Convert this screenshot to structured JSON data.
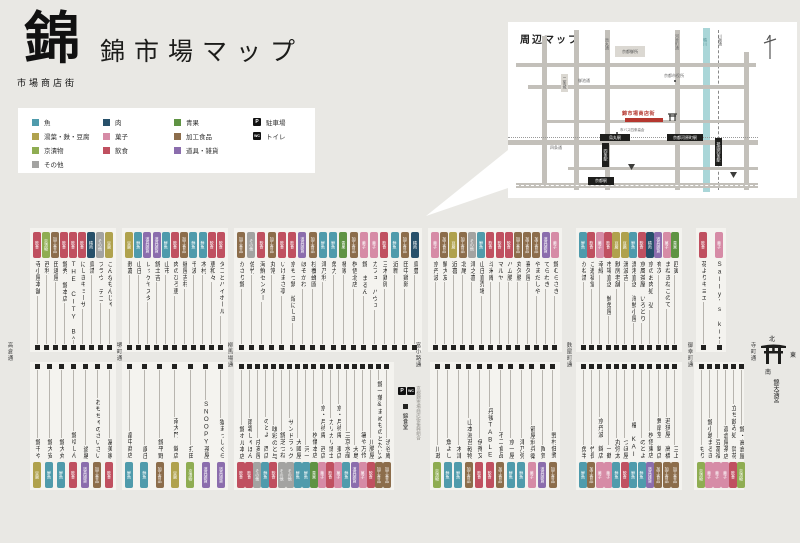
{
  "header": {
    "logo": "錦",
    "logo_sub": "市場商店街",
    "title": "錦市場マップ"
  },
  "categories": {
    "fish": {
      "label": "魚",
      "chip": "鮮魚",
      "color": "#4f9bac"
    },
    "tofu": {
      "label": "湯葉・麩・豆腐",
      "chip": "豆腐",
      "color": "#b0a24d"
    },
    "pickles": {
      "label": "京漬物",
      "chip": "京漬物",
      "color": "#8fad52"
    },
    "other": {
      "label": "その他",
      "chip": "その他",
      "color": "#a3a3a1"
    },
    "meat": {
      "label": "肉",
      "chip": "精肉",
      "color": "#27506a"
    },
    "sweets": {
      "label": "菓子",
      "chip": "菓子",
      "color": "#d68ba6"
    },
    "dining": {
      "label": "飲食",
      "chip": "飲食",
      "color": "#c05060"
    },
    "produce": {
      "label": "青果",
      "chip": "青果",
      "color": "#5f9343"
    },
    "processed": {
      "label": "加工食品",
      "chip": "加工食品",
      "color": "#8c6d4b"
    },
    "goods": {
      "label": "道具・雑貨",
      "chip": "道具雑貨",
      "color": "#8b6dad"
    }
  },
  "legend_order": [
    [
      "fish",
      "tofu",
      "pickles",
      "other"
    ],
    [
      "meat",
      "sweets",
      "dining"
    ],
    [
      "produce",
      "processed",
      "goods"
    ]
  ],
  "facilities": [
    {
      "icon": "P",
      "label": "駐車場"
    },
    {
      "icon": "WC",
      "label": "トイレ"
    }
  ],
  "minimap": {
    "title": "周辺マップ",
    "highlight": "錦市場商店街",
    "stations": {
      "karasuma": "烏丸駅",
      "shijo_sta": "四条駅",
      "kawaramachi_sta": "京都河原町駅",
      "gion": "祇園四条駅",
      "kyoto": "京都駅"
    },
    "landmarks": {
      "gosho": "京都御所",
      "cityhall": "京都市役所",
      "nijo": "二条城",
      "bus": "市バス四条高倉"
    },
    "streets": {
      "karasuma": "烏丸通",
      "kawaramachi": "河原町通",
      "kawabata": "川端通",
      "kamo": "鴨川",
      "oike": "御池通",
      "shijo": "四条通"
    }
  },
  "streets": [
    "高倉通",
    "堺町通",
    "柳馬場通",
    "富小路通",
    "麩屋町通",
    "御幸町通",
    "寺町通"
  ],
  "compass": {
    "n": "北",
    "e": "東",
    "s": "南",
    "shrine": "錦天満宮"
  },
  "parking_block": {
    "p": "P",
    "toilet": "WC",
    "shop": "錦食堂",
    "office": "京都錦市場商店街振興組合"
  },
  "top_blocks": [
    {
      "shops": [
        {
          "n": "寺小屋本舗",
          "c": "dining"
        },
        {
          "n": "西利",
          "c": "pickles"
        },
        {
          "n": "田邊屋",
          "c": "processed"
        },
        {
          "n": "錦秀 錦本店",
          "c": "dining"
        },
        {
          "n": "THE CITY BAKERY",
          "c": "dining"
        },
        {
          "n": "にしきギョーザ",
          "c": "dining"
        },
        {
          "n": "鳥清",
          "c": "meat"
        },
        {
          "n": "ブラウ デコ",
          "c": "other"
        },
        {
          "n": "こんなもんじゃ",
          "c": "tofu"
        }
      ]
    },
    {
      "shops": [
        {
          "n": "麩嘉",
          "c": "tofu"
        },
        {
          "n": "山庄",
          "c": "fish"
        },
        {
          "n": "レッゲヤスダ",
          "c": "goods"
        },
        {
          "n": "錦土吉",
          "c": "goods"
        },
        {
          "n": "山市",
          "c": "fish"
        },
        {
          "n": "肉のひろ恵",
          "c": "dining"
        },
        {
          "n": "縁屋吉村",
          "c": "processed"
        },
        {
          "n": "千波",
          "c": "fish"
        },
        {
          "n": "木村",
          "c": "fish"
        },
        {
          "n": "恵和々",
          "c": "dining"
        },
        {
          "n": "タコとハイボール",
          "c": "dining"
        }
      ]
    },
    {
      "shops": [
        {
          "n": "かざり錦",
          "c": "processed"
        },
        {
          "n": "佐竹",
          "c": "other"
        },
        {
          "n": "海鮮センター",
          "c": "dining"
        },
        {
          "n": "丸常",
          "c": "processed"
        },
        {
          "n": "いけまさ亭",
          "c": "dining"
        },
        {
          "n": "京もつ鍋 焔にしき",
          "c": "dining"
        },
        {
          "n": "ほそかわ",
          "c": "goods"
        },
        {
          "n": "杉養蜂園",
          "c": "processed"
        },
        {
          "n": "津乃利",
          "c": "fish"
        },
        {
          "n": "魚力",
          "c": "fish"
        },
        {
          "n": "椿家",
          "c": "produce"
        },
        {
          "n": "桝俉北店",
          "c": "processed"
        },
        {
          "n": "錦 まるん",
          "c": "sweets"
        },
        {
          "n": "カフェ パヴェ",
          "c": "sweets"
        },
        {
          "n": "三木鶏卵",
          "c": "dining"
        },
        {
          "n": "近新",
          "c": "fish"
        },
        {
          "n": "田中鶏卵",
          "c": "processed"
        },
        {
          "n": "鳥豊",
          "c": "meat"
        }
      ]
    },
    {
      "shops": [
        {
          "n": "京丹波",
          "c": "sweets"
        },
        {
          "n": "鯛大友",
          "c": "processed"
        },
        {
          "n": "近喜",
          "c": "tofu"
        },
        {
          "n": "北尾",
          "c": "processed"
        },
        {
          "n": "津之喜",
          "c": "other"
        },
        {
          "n": "山庄直売場",
          "c": "fish"
        },
        {
          "n": "斗米庵",
          "c": "dining"
        },
        {
          "n": "マルヤ",
          "c": "dining"
        },
        {
          "n": "ハム勝",
          "c": "dining"
        },
        {
          "n": "丸久勝",
          "c": "processed"
        },
        {
          "n": "喜久屋",
          "c": "processed"
        },
        {
          "n": "やまだしや",
          "c": "processed"
        },
        {
          "n": "てらわき",
          "c": "goods"
        },
        {
          "n": "錦むらさき",
          "c": "sweets"
        }
      ]
    },
    {
      "shops": [
        {
          "n": "かね清",
          "c": "fish"
        },
        {
          "n": "ご進福堂",
          "c": "dining"
        },
        {
          "n": "幸緑",
          "c": "sweets"
        },
        {
          "n": "市場直送 鮮魚屋",
          "c": "dining"
        },
        {
          "n": "麩房老舗",
          "c": "tofu"
        },
        {
          "n": "湯波吉",
          "c": "tofu"
        },
        {
          "n": "漁港直送 海鮮小屋",
          "c": "fish"
        },
        {
          "n": "京風茶屋 いろどり",
          "c": "dining"
        },
        {
          "n": "京のお肉処 弘",
          "c": "meat"
        },
        {
          "n": "有次",
          "c": "goods"
        },
        {
          "n": "まねきねこのて",
          "c": "sweets"
        },
        {
          "n": "四寅",
          "c": "produce"
        }
      ]
    },
    {
      "shops": [
        {
          "n": "花よりキヨエ",
          "c": "dining"
        },
        {
          "n": "Sally's kitchen",
          "c": "sweets"
        }
      ]
    }
  ],
  "bottom_blocks": [
    {
      "shops": [
        {
          "n": "錦千や",
          "c": "tofu"
        },
        {
          "n": "錦大安",
          "c": "fish"
        },
        {
          "n": "錦大丸",
          "c": "fish"
        },
        {
          "n": "錦ゆしん",
          "c": "dining"
        },
        {
          "n": "遊膳",
          "c": "goods"
        },
        {
          "n": "おもちゃのさいさい",
          "c": "processed"
        },
        {
          "n": "冨美家",
          "c": "dining"
        }
      ]
    },
    {
      "shops": [
        {
          "n": "畠中商店",
          "c": "fish"
        },
        {
          "n": "廣庄",
          "c": "fish"
        },
        {
          "n": "錦平野",
          "c": "processed"
        },
        {
          "n": "南大門 錦店",
          "c": "tofu"
        },
        {
          "n": "打田",
          "c": "pickles"
        },
        {
          "n": "SNOOPY茶屋",
          "c": "goods"
        },
        {
          "n": "猫まっしぐら",
          "c": "goods"
        }
      ]
    },
    {
      "shops": [
        {
          "n": "錦ホル本店",
          "c": "dining"
        },
        {
          "n": "雨霜しゃぼん",
          "c": "dining"
        },
        {
          "n": "戌亥屋",
          "c": "other"
        },
        {
          "n": "のとよ 西店",
          "c": "fish"
        },
        {
          "n": "味彩のと与",
          "c": "dining"
        },
        {
          "n": "錦芝つね",
          "c": "other"
        },
        {
          "n": "サンドラッグ",
          "c": "other"
        },
        {
          "n": "大國屋",
          "c": "fish"
        },
        {
          "n": "河一",
          "c": "fish"
        },
        {
          "n": "桝儀本店",
          "c": "produce"
        },
        {
          "n": "京・月待庵 西店",
          "c": "sweets"
        },
        {
          "n": "カリカリ博士",
          "c": "dining"
        },
        {
          "n": "京・月待庵 東店",
          "c": "sweets"
        },
        {
          "n": "三京水産",
          "c": "fish"
        },
        {
          "n": "大島",
          "c": "goods"
        },
        {
          "n": "箸や万作",
          "c": "sweets"
        },
        {
          "n": "川勝屋",
          "c": "dining"
        },
        {
          "n": "錦一葉&まめものとたいやき",
          "c": "processed"
        },
        {
          "n": "渋谷庵",
          "c": "processed"
        }
      ]
    },
    {
      "shops": [
        {
          "n": "川政",
          "c": "pickles"
        },
        {
          "n": "魚よし",
          "c": "fish"
        },
        {
          "n": "木津",
          "c": "fish"
        },
        {
          "n": "山本海苔乾物",
          "c": "processed"
        },
        {
          "n": "伊豫又",
          "c": "dining"
        },
        {
          "n": "丹後TABLE",
          "c": "dining"
        },
        {
          "n": "不二食品",
          "c": "processed"
        },
        {
          "n": "京一屋",
          "c": "fish"
        },
        {
          "n": "津乃弥",
          "c": "fish"
        },
        {
          "n": "箭屋利兵衛",
          "c": "sweets"
        },
        {
          "n": "陶賀",
          "c": "goods"
        },
        {
          "n": "野村佃煮",
          "c": "processed"
        }
      ]
    },
    {
      "shops": [
        {
          "n": "魚半",
          "c": "fish"
        },
        {
          "n": "竹長",
          "c": "processed"
        },
        {
          "n": "京丹波 錦店",
          "c": "sweets"
        },
        {
          "n": "一鶴",
          "c": "sweets"
        },
        {
          "n": "丸弥太",
          "c": "fish"
        },
        {
          "n": "つぼ屋",
          "c": "dining"
        },
        {
          "n": "櫂 KAI",
          "c": "fish"
        },
        {
          "n": "のとよ",
          "c": "fish"
        },
        {
          "n": "桝俉東店",
          "c": "goods"
        },
        {
          "n": "舞扇堂 錦店",
          "c": "processed"
        },
        {
          "n": "若狭屋 高橋",
          "c": "processed"
        },
        {
          "n": "三上",
          "c": "processed"
        }
      ]
    },
    {
      "shops": [
        {
          "n": "もり",
          "c": "pickles"
        },
        {
          "n": "錦小路まるき",
          "c": "sweets"
        },
        {
          "n": "豆冨福",
          "c": "sweets"
        },
        {
          "n": "高倉屋茶店",
          "c": "sweets"
        },
        {
          "n": "立ち飲み処 賀花",
          "c": "dining"
        },
        {
          "n": "錦・高倉屋",
          "c": "pickles"
        }
      ]
    }
  ]
}
